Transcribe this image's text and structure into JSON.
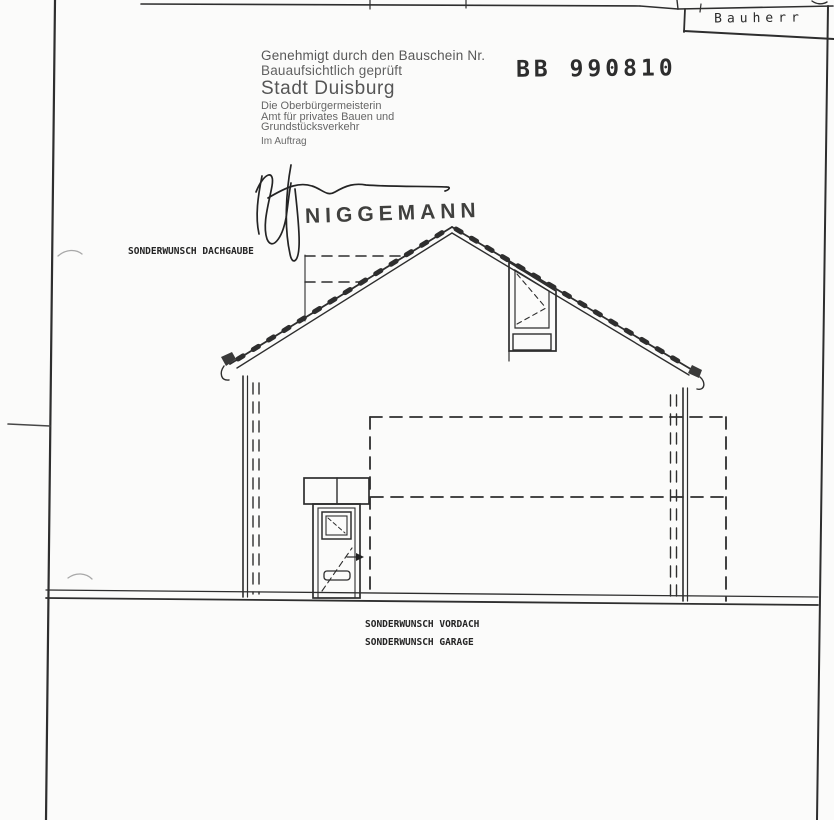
{
  "title_block": {
    "bauherr_label": "Bauherr"
  },
  "approval_stamp": {
    "lines": [
      "Genehmigt durch den Bauschein Nr.",
      "Bauaufsichtlich geprüft",
      "Stadt Duisburg",
      "Die Oberbürgermeisterin",
      "Amt für privates Bauen und",
      "Grundstücksverkehr",
      "Im Auftrag"
    ],
    "permit_number": "BB 990810"
  },
  "signature": {
    "name_stamp": "NIGGEMANN"
  },
  "annotations": {
    "dachgaube": "SONDERWUNSCH DACHGAUBE",
    "vordach": "SONDERWUNSCH VORDACH",
    "garage": "SONDERWUNSCH GARAGE"
  },
  "colors": {
    "paper": "#fbfbfa",
    "ink": "#2e2e2e",
    "stamp_ink": "#585858"
  }
}
